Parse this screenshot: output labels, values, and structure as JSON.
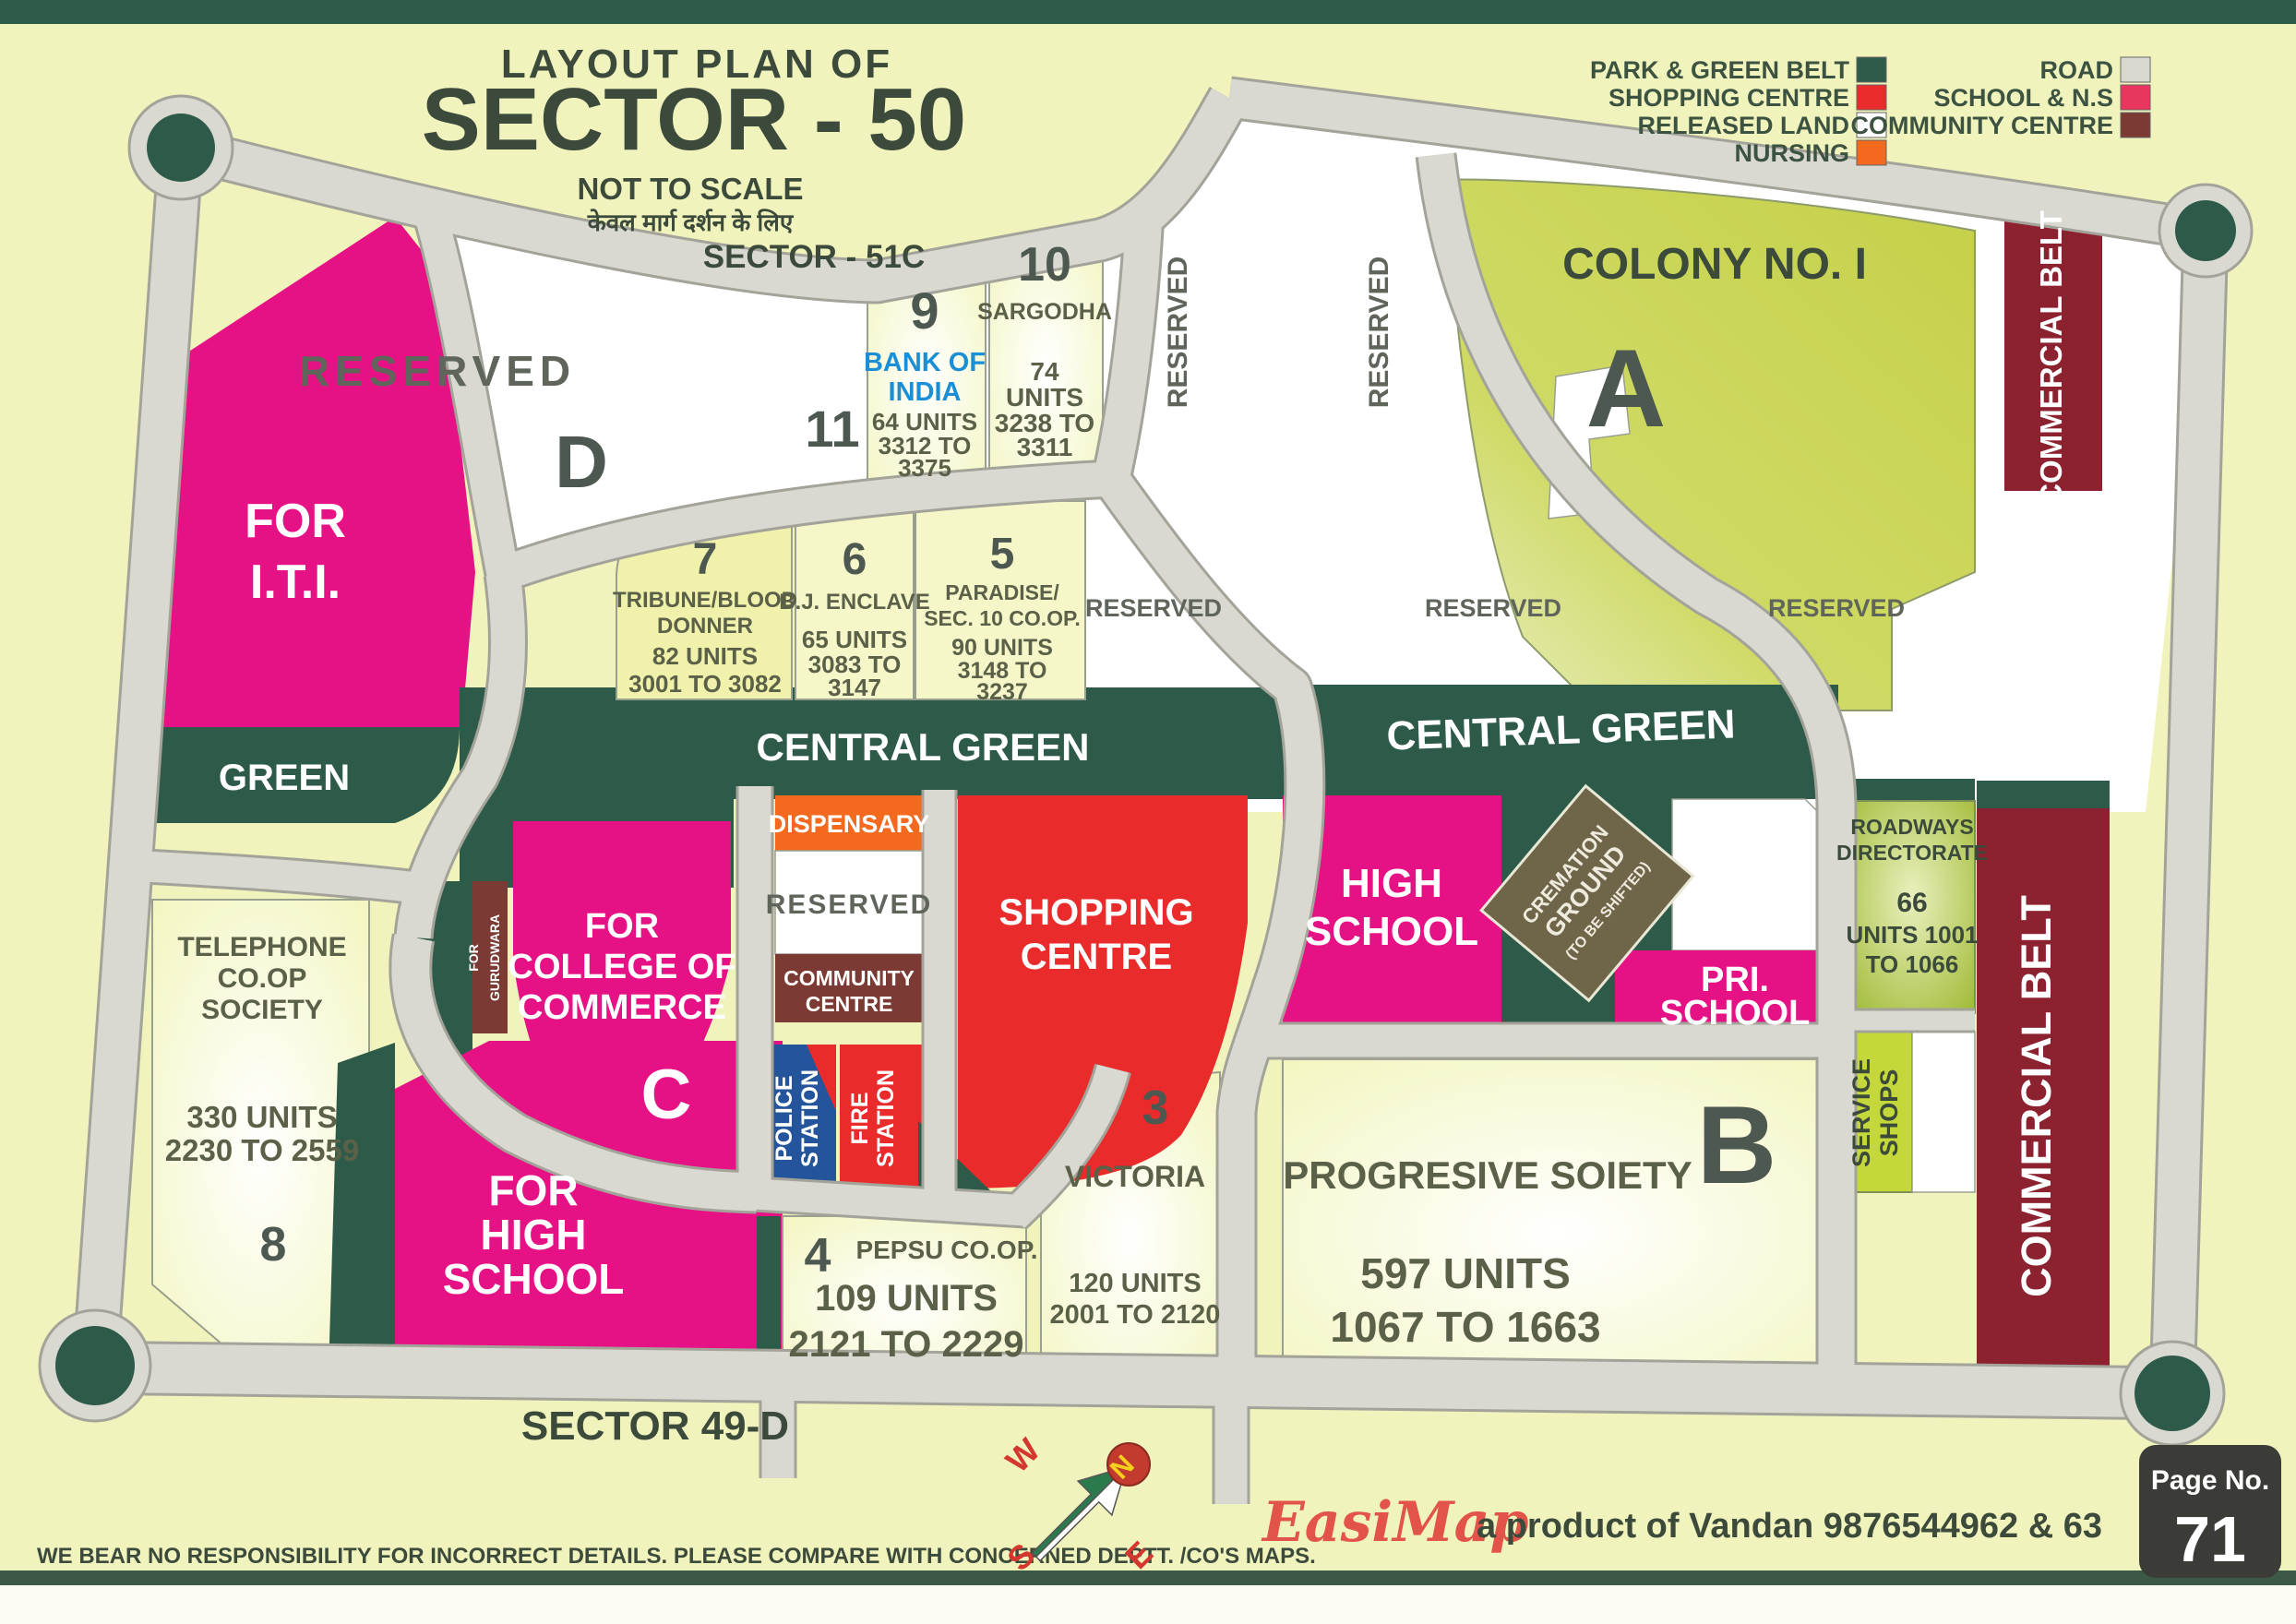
{
  "header": {
    "title_line1": "LAYOUT PLAN OF",
    "title_line2": "SECTOR - 50",
    "scale_note": "NOT TO SCALE",
    "scale_note_hindi": "केवल मार्ग दर्शन के लिए",
    "adjacent_sector_top": "SECTOR - 51C",
    "adjacent_sector_bottom": "SECTOR 49-D"
  },
  "legend": {
    "col1": [
      {
        "label": "PARK & GREEN BELT",
        "color": "#2e5b49"
      },
      {
        "label": "SHOPPING CENTRE",
        "color": "#e92b2b"
      },
      {
        "label": "RELEASED LAND",
        "color": "#ffffff"
      },
      {
        "label": "NURSING",
        "color": "#f3691e"
      }
    ],
    "col2": [
      {
        "label": "ROAD",
        "color": "#d9d9d1"
      },
      {
        "label": "SCHOOL & N.S",
        "color": "#e8365e"
      },
      {
        "label": "COMMUNITY CENTRE",
        "color": "#7b3a33"
      }
    ]
  },
  "labels": {
    "reserved": "RESERVED",
    "central_green": "CENTRAL GREEN",
    "commercial_belt": "COMMERCIAL BELT",
    "green": "GREEN"
  },
  "zones": {
    "iti_line1": "FOR",
    "iti_line2": "I.T.I.",
    "d_letter": "D",
    "plot11": "11",
    "colony_name": "COLONY NO. I",
    "colony_letter": "A",
    "college_line1": "FOR",
    "college_line2": "COLLEGE OF",
    "college_line3": "COMMERCE",
    "college_letter": "C",
    "gurudwara_line1": "FOR",
    "gurudwara_line2": "GURUDWARA",
    "dispensary": "DISPENSARY",
    "community_line1": "COMMUNITY",
    "community_line2": "CENTRE",
    "police_line1": "POLICE",
    "police_line2": "STATION",
    "fire_line1": "FIRE",
    "fire_line2": "STATION",
    "shopping_line1": "SHOPPING",
    "shopping_line2": "CENTRE",
    "high_school_line1": "HIGH",
    "high_school_line2": "SCHOOL",
    "cremation_line1": "CREMATION",
    "cremation_line2": "GROUND",
    "cremation_line3": "(TO BE SHIFTED)",
    "pri_line1": "PRI.",
    "pri_line2": "SCHOOL",
    "roadways_line1": "ROADWAYS",
    "roadways_line2": "DIRECTORATE",
    "roadways_units1": "66",
    "roadways_units2": "UNITS 1001",
    "roadways_units3": "TO 1066",
    "service_line1": "SERVICE",
    "service_line2": "SHOPS",
    "b_name": "PROGRESIVE SOIETY",
    "b_units": "597 UNITS",
    "b_range": "1067 TO 1663",
    "b_letter": "B",
    "fhs_line1": "FOR",
    "fhs_line2": "HIGH",
    "fhs_line3": "SCHOOL",
    "telephone_line1": "TELEPHONE",
    "telephone_line2": "CO.OP",
    "telephone_line3": "SOCIETY",
    "telephone_units": "330 UNITS",
    "telephone_range": "2230 TO 2559",
    "telephone_num": "8"
  },
  "plots": {
    "p9": {
      "num": "9",
      "name1": "BANK OF",
      "name2": "INDIA",
      "units": "64 UNITS",
      "range1": "3312 TO",
      "range2": "3375"
    },
    "p10": {
      "num": "10",
      "name": "SARGODHA",
      "units1": "74",
      "units2": "UNITS",
      "range1": "3238 TO",
      "range2": "3311"
    },
    "p7": {
      "num": "7",
      "name1": "TRIBUNE/BLOOD",
      "name2": "DONNER",
      "units": "82 UNITS",
      "range": "3001 TO 3082"
    },
    "p6": {
      "num": "6",
      "name": "B.J. ENCLAVE",
      "units": "65 UNITS",
      "range1": "3083 TO",
      "range2": "3147"
    },
    "p5": {
      "num": "5",
      "name1": "PARADISE/",
      "name2": "SEC. 10 CO.OP.",
      "units": "90 UNITS",
      "range1": "3148 TO",
      "range2": "3237"
    },
    "p4": {
      "num": "4",
      "name": "PEPSU CO.OP.",
      "units": "109 UNITS",
      "range": "2121 TO 2229"
    },
    "p3": {
      "num": "3",
      "name": "VICTORIA",
      "units": "120 UNITS",
      "range": "2001 TO 2120"
    }
  },
  "compass": {
    "n": "N",
    "s": "S",
    "e": "E",
    "w": "W"
  },
  "footer": {
    "disclaimer": "WE BEAR NO RESPONSIBILITY FOR INCORRECT DETAILS. PLEASE COMPARE WITH CONCERNED DEPTT. /CO'S MAPS.",
    "brand": "EasiMap",
    "brand_tagline": "a product of Vandan 9876544962 & 63",
    "page_label": "Page No.",
    "page_number": "71"
  }
}
